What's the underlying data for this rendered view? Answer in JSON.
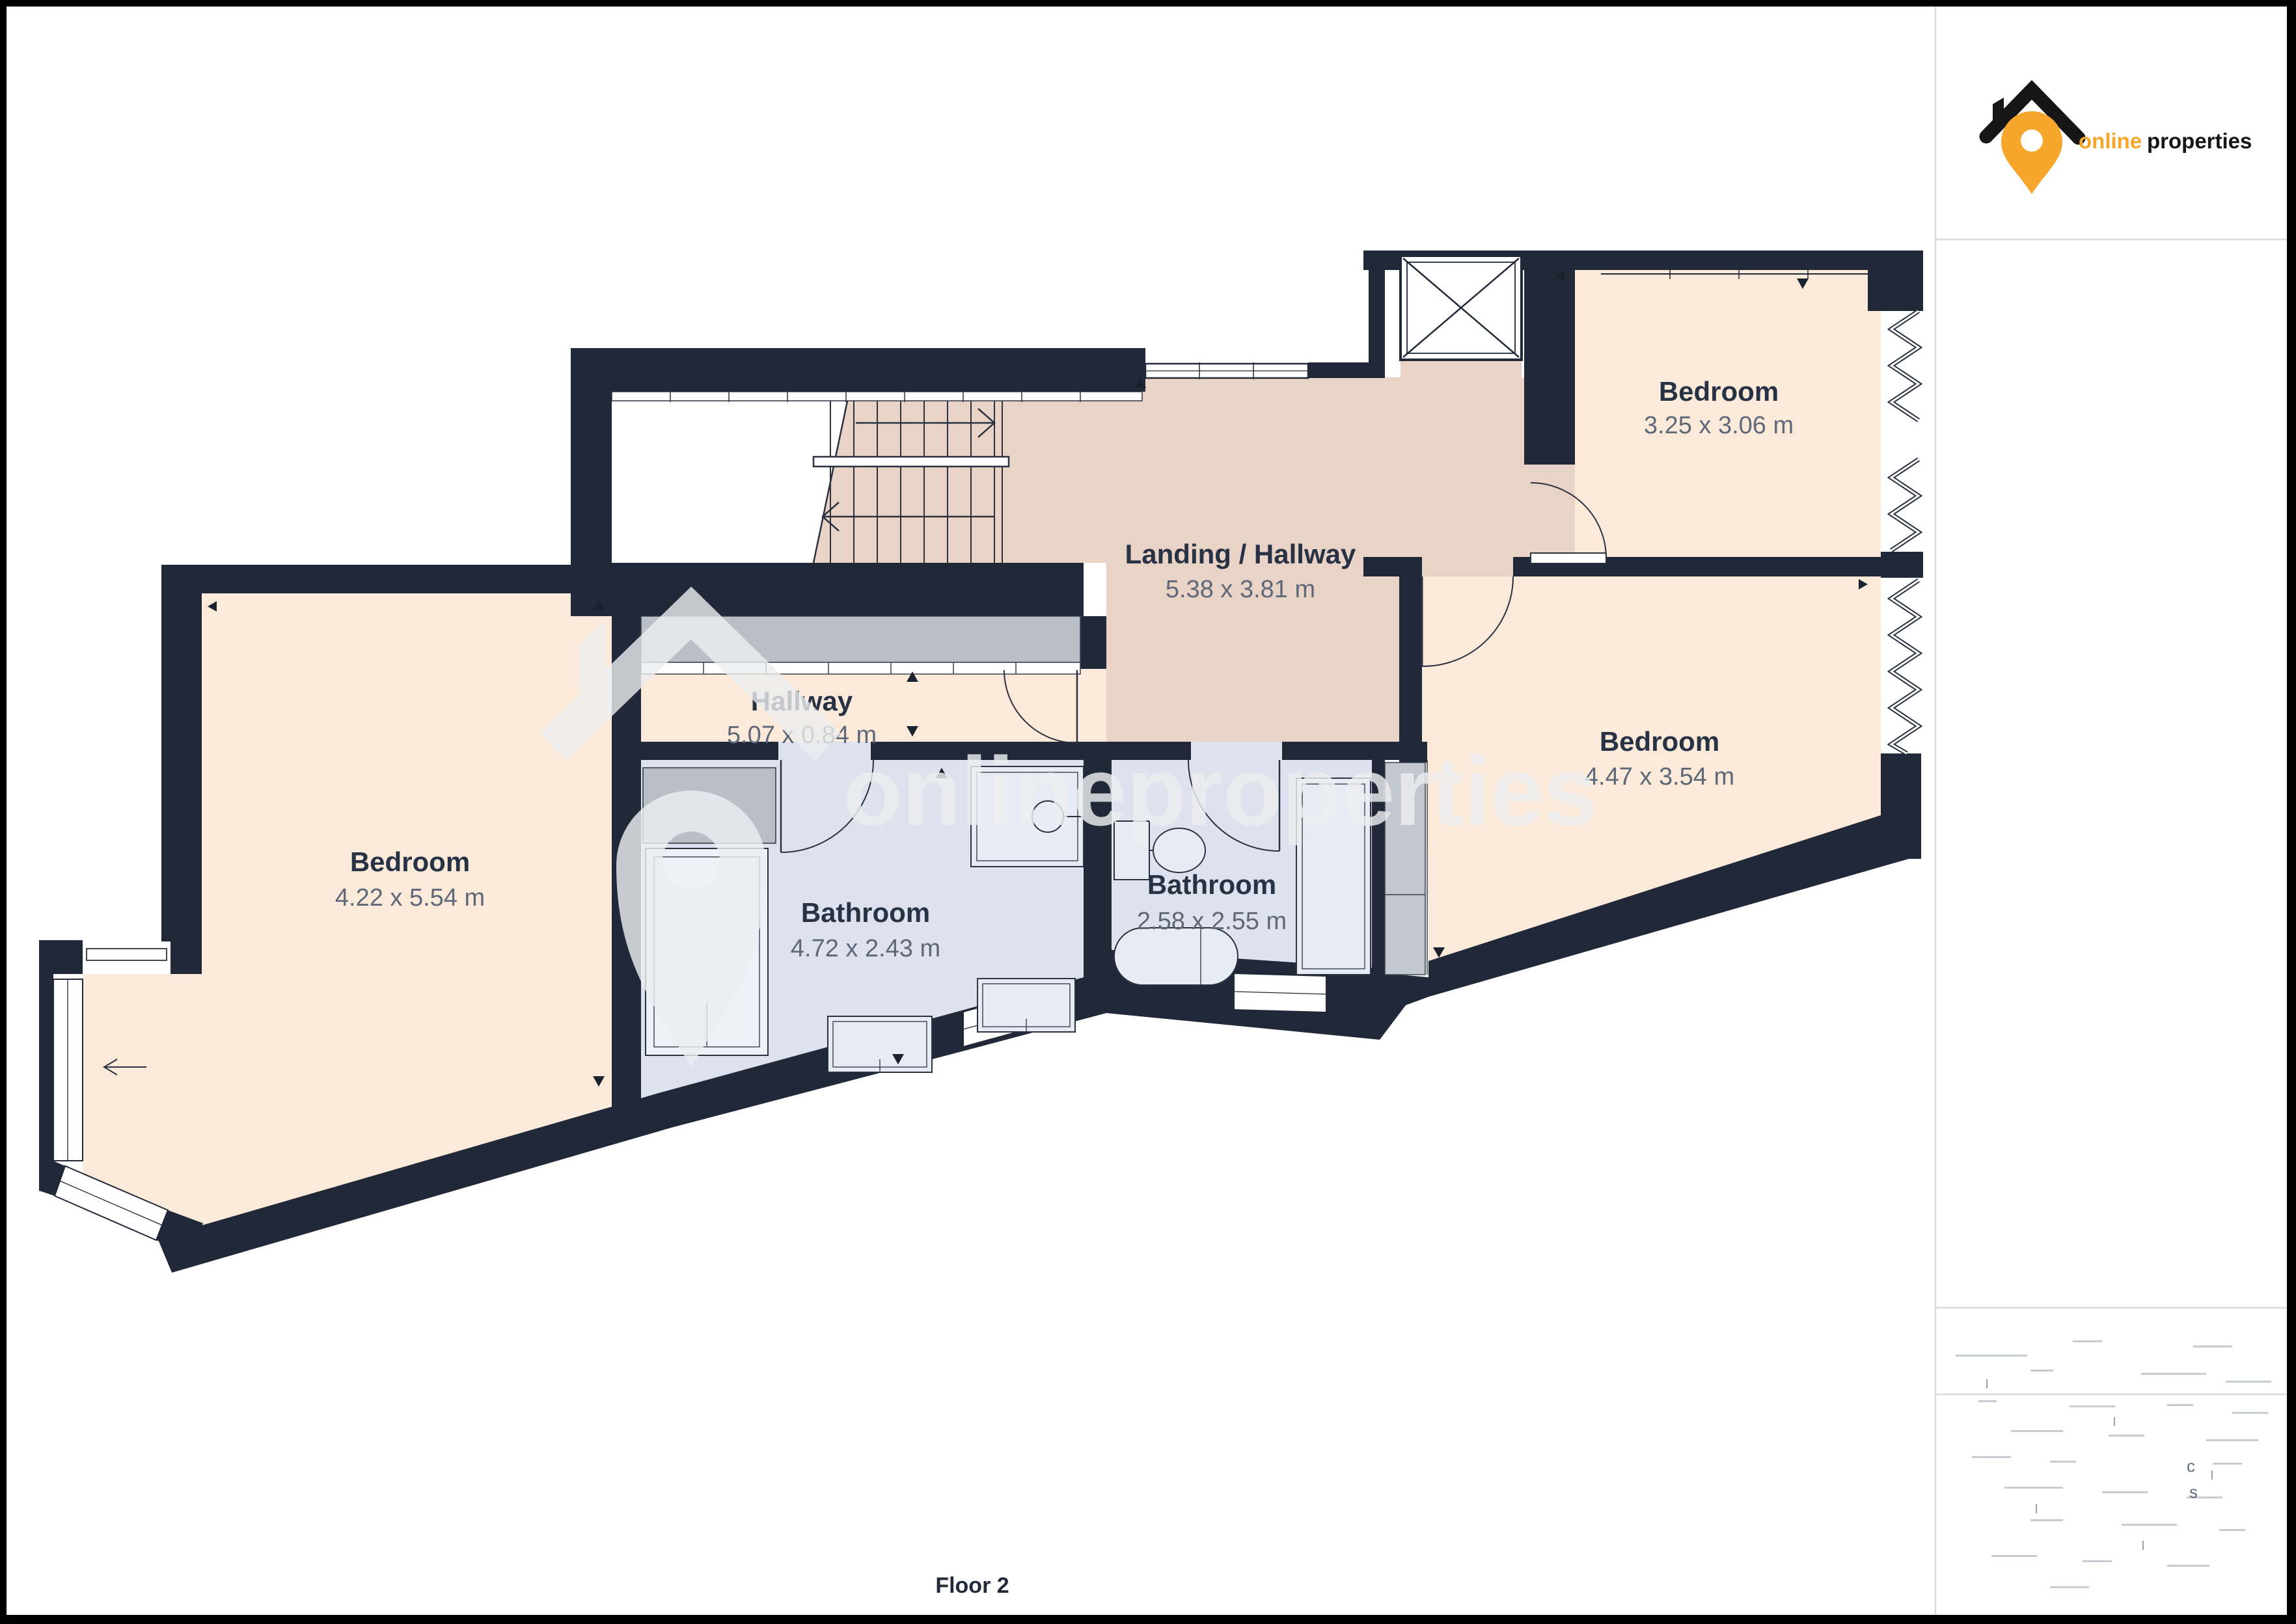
{
  "branding": {
    "name_part1": "online",
    "name_part2": "properties",
    "accent_color": "#f5a62b"
  },
  "watermark": {
    "text": "onlineproperties"
  },
  "floor": {
    "label": "Floor 2"
  },
  "rooms": {
    "bedroom_top": {
      "name": "Bedroom",
      "dims": "3.25 x 3.06 m"
    },
    "landing": {
      "name": "Landing / Hallway",
      "dims": "5.38 x 3.81 m"
    },
    "hallway": {
      "name": "Hallway",
      "dims": "5.07 x 0.84 m"
    },
    "bedroom_right": {
      "name": "Bedroom",
      "dims": "4.47 x 3.54 m"
    },
    "bedroom_left": {
      "name": "Bedroom",
      "dims": "4.22 x 5.54 m"
    },
    "bathroom_main": {
      "name": "Bathroom",
      "dims": "4.72 x 2.43 m"
    },
    "bathroom_small": {
      "name": "Bathroom",
      "dims": "2.58 x 2.55 m"
    }
  },
  "colors": {
    "wall": "#212838",
    "bedroom_fill": "#fbead9",
    "landing_fill": "#e9d2c6",
    "bathroom_fill": "#dde2ee",
    "wardrobe_gray": "#b9bec7",
    "accent_orange": "#f5a62b"
  },
  "faint_chars": {
    "c": "c",
    "s": "s"
  }
}
